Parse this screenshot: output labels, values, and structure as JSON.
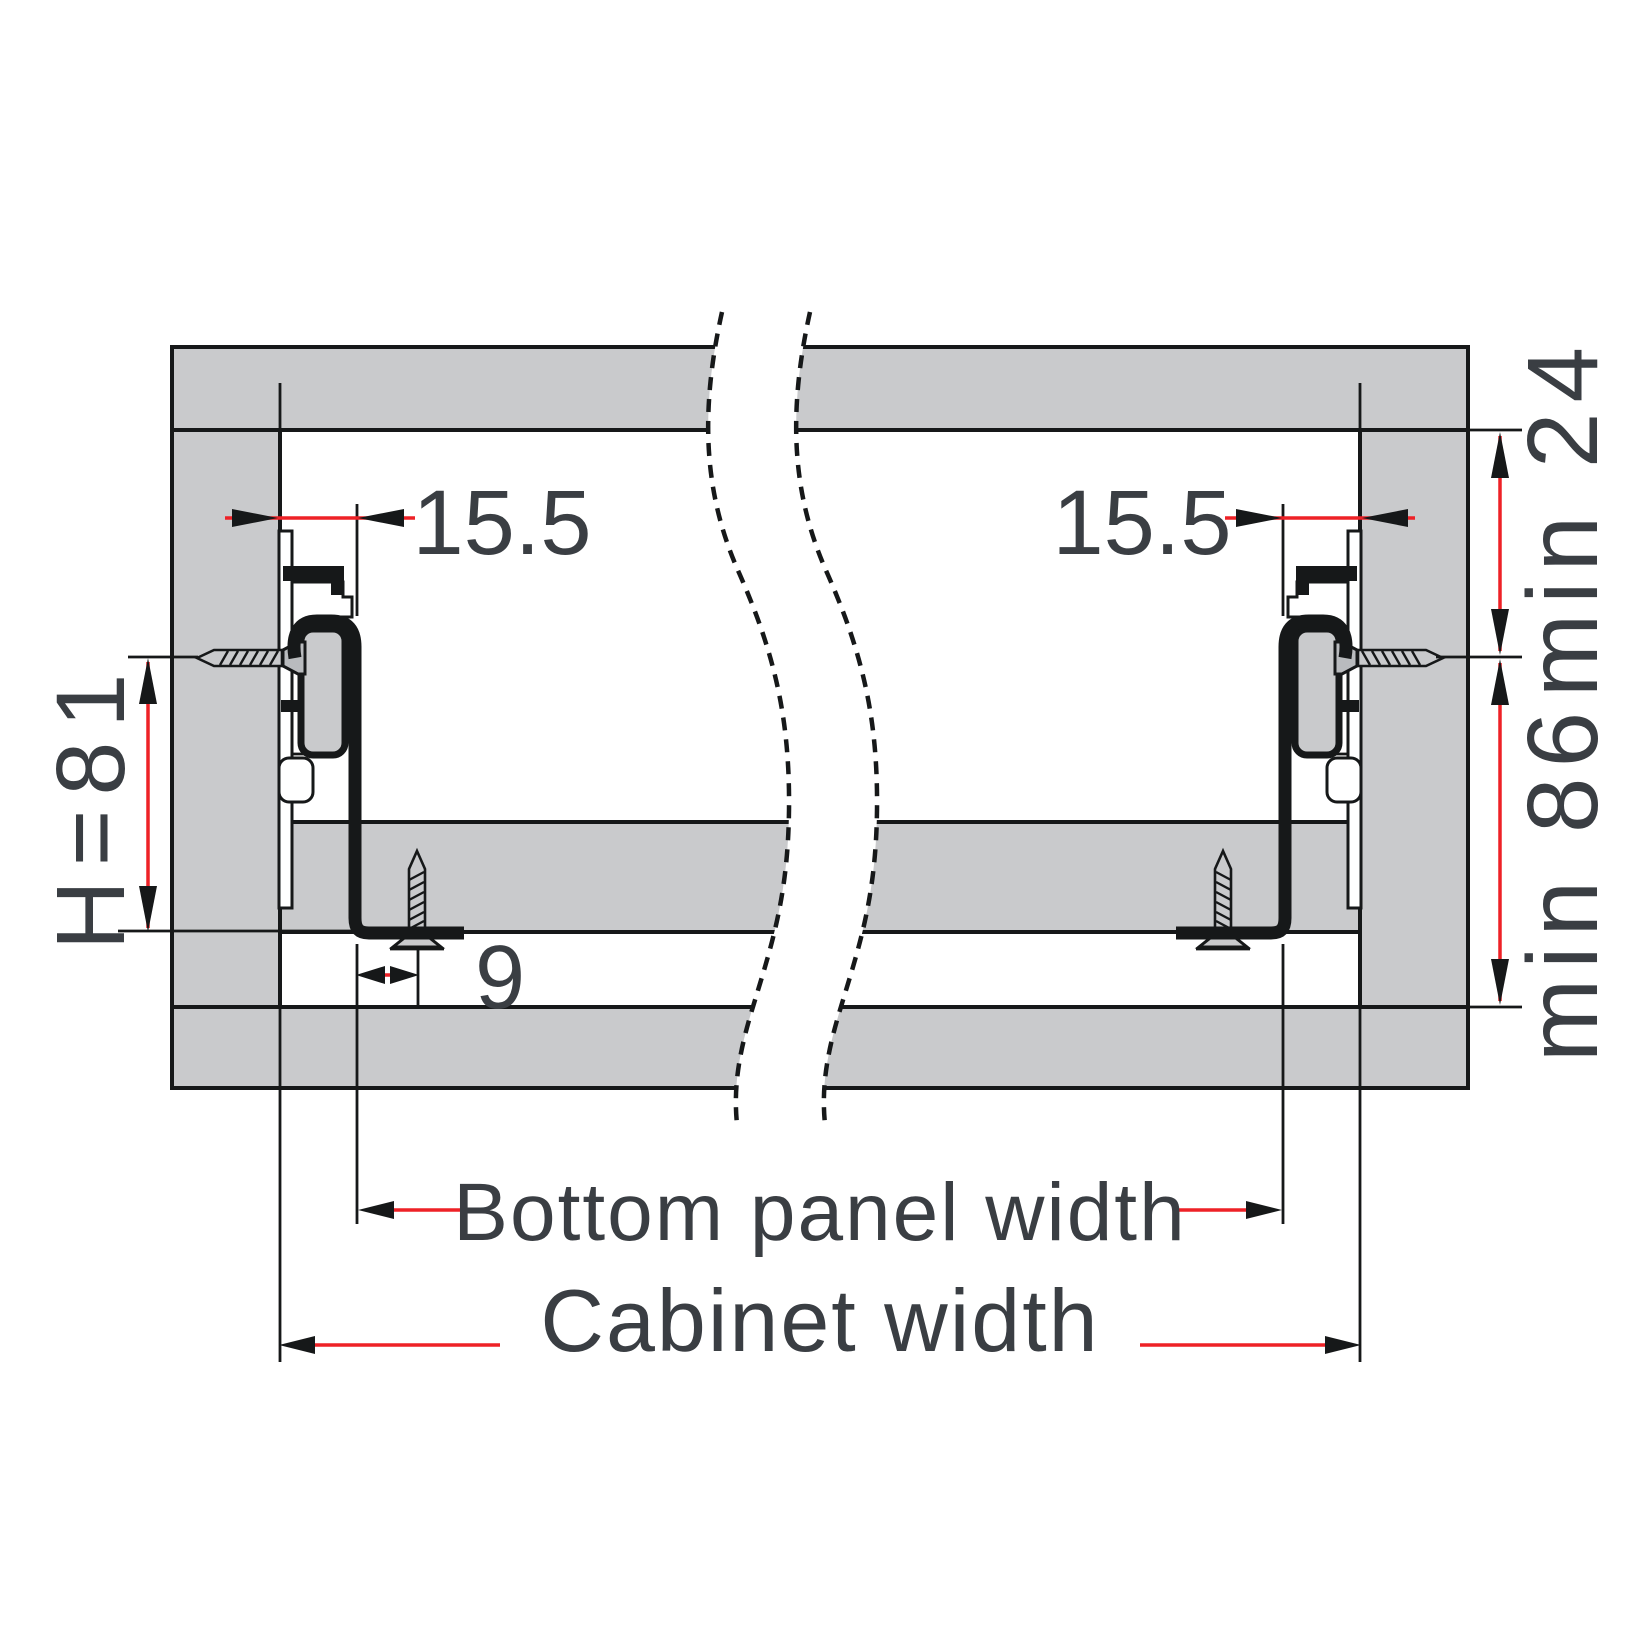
{
  "diagram": {
    "kind": "technical-drawing",
    "dimensions": {
      "left_slide_offset": {
        "label": "15.5"
      },
      "right_slide_offset": {
        "label": "15.5"
      },
      "slide_height": {
        "label": "H=81"
      },
      "screw_setback": {
        "label": "9"
      },
      "top_clearance": {
        "label": "min 24"
      },
      "min_internal_height": {
        "label": "min 86"
      },
      "bottom_panel_width": {
        "label": "Bottom panel width"
      },
      "cabinet_width": {
        "label": "Cabinet width"
      }
    },
    "colors": {
      "panel_fill": "#c9cacc",
      "outline": "#161819",
      "dimension_red": "#ee2126",
      "text": "#3a3e43",
      "background": "#ffffff"
    },
    "parts": {
      "top_rail": "cabinet-top-rail",
      "left_panel": "left-side-panel",
      "right_panel": "right-side-panel",
      "bottom_rail": "cabinet-bottom-rail",
      "bottom_panel": "drawer-bottom-panel",
      "slide": "drawer-slide-profile",
      "screws": "mounting-screw"
    }
  }
}
